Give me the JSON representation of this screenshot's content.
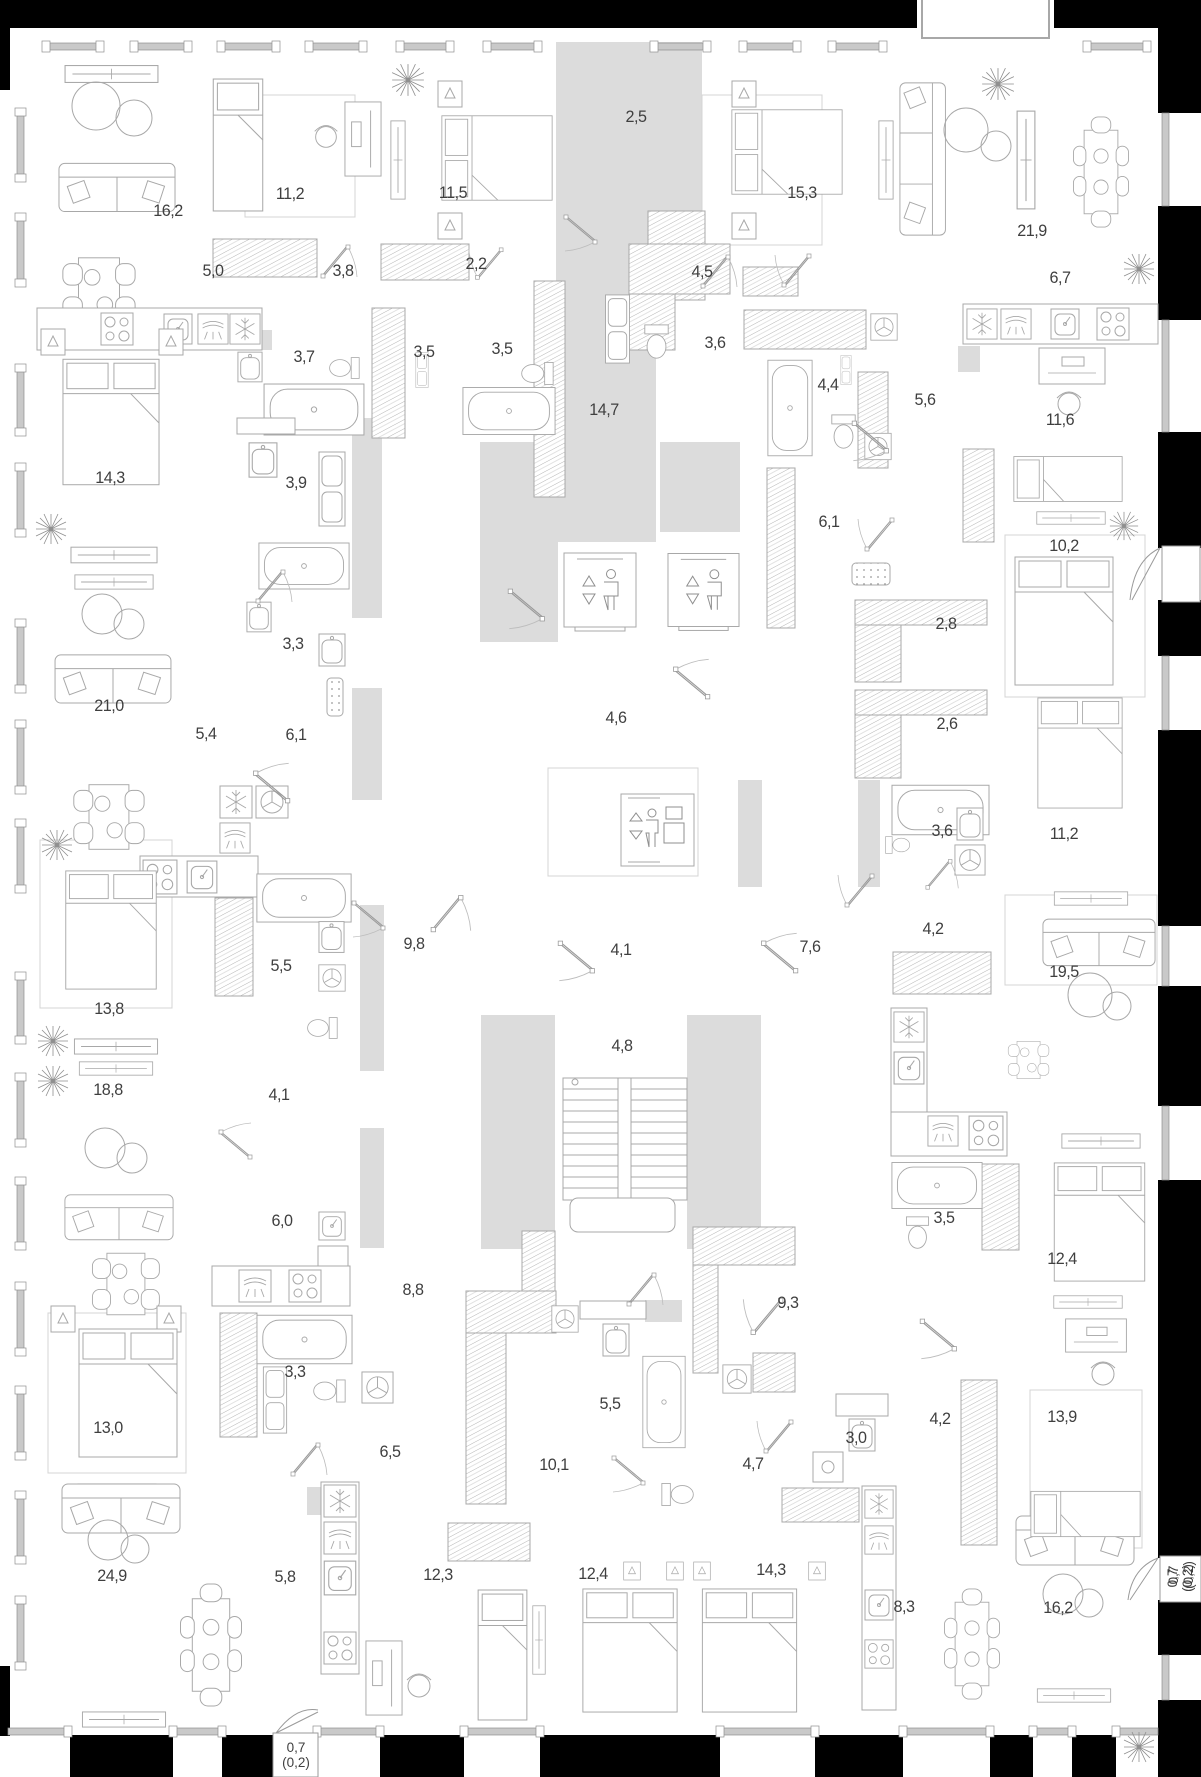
{
  "plan_title": "floor-plan",
  "colors": {
    "wall": "#000000",
    "corridor_fill": "#dcdcdc",
    "line": "#a8a8a8",
    "window_bar": "#c9c9c9",
    "label_color": "#3f3f3f"
  },
  "rooms": [
    {
      "label": "16,2",
      "x": 168,
      "y": 211
    },
    {
      "label": "11,2",
      "x": 290,
      "y": 194
    },
    {
      "label": "11,5",
      "x": 453,
      "y": 193
    },
    {
      "label": "2,5",
      "x": 636,
      "y": 117
    },
    {
      "label": "15,3",
      "x": 802,
      "y": 193
    },
    {
      "label": "21,9",
      "x": 1032,
      "y": 231
    },
    {
      "label": "5,0",
      "x": 213,
      "y": 271
    },
    {
      "label": "3,8",
      "x": 343,
      "y": 271
    },
    {
      "label": "2,2",
      "x": 476,
      "y": 264
    },
    {
      "label": "4,5",
      "x": 702,
      "y": 272
    },
    {
      "label": "6,7",
      "x": 1060,
      "y": 278
    },
    {
      "label": "3,7",
      "x": 304,
      "y": 357
    },
    {
      "label": "3,5",
      "x": 424,
      "y": 352
    },
    {
      "label": "3,5",
      "x": 502,
      "y": 349
    },
    {
      "label": "3,6",
      "x": 715,
      "y": 343
    },
    {
      "label": "4,4",
      "x": 828,
      "y": 385
    },
    {
      "label": "5,6",
      "x": 925,
      "y": 400
    },
    {
      "label": "11,6",
      "x": 1060,
      "y": 420
    },
    {
      "label": "14,7",
      "x": 604,
      "y": 410
    },
    {
      "label": "14,3",
      "x": 110,
      "y": 478
    },
    {
      "label": "3,9",
      "x": 296,
      "y": 483
    },
    {
      "label": "6,1",
      "x": 829,
      "y": 522
    },
    {
      "label": "10,2",
      "x": 1064,
      "y": 546
    },
    {
      "label": "2,8",
      "x": 946,
      "y": 624
    },
    {
      "label": "3,3",
      "x": 293,
      "y": 644
    },
    {
      "label": "21,0",
      "x": 109,
      "y": 706
    },
    {
      "label": "5,4",
      "x": 206,
      "y": 734
    },
    {
      "label": "6,1",
      "x": 296,
      "y": 735
    },
    {
      "label": "4,6",
      "x": 616,
      "y": 718
    },
    {
      "label": "2,6",
      "x": 947,
      "y": 724
    },
    {
      "label": "3,6",
      "x": 942,
      "y": 831
    },
    {
      "label": "11,2",
      "x": 1064,
      "y": 834
    },
    {
      "label": "19,5",
      "x": 1064,
      "y": 972
    },
    {
      "label": "5,5",
      "x": 281,
      "y": 966
    },
    {
      "label": "9,8",
      "x": 414,
      "y": 944
    },
    {
      "label": "4,1",
      "x": 621,
      "y": 950
    },
    {
      "label": "7,6",
      "x": 810,
      "y": 947
    },
    {
      "label": "4,2",
      "x": 933,
      "y": 929
    },
    {
      "label": "13,8",
      "x": 109,
      "y": 1009
    },
    {
      "label": "4,8",
      "x": 622,
      "y": 1046
    },
    {
      "label": "18,8",
      "x": 108,
      "y": 1090
    },
    {
      "label": "4,1",
      "x": 279,
      "y": 1095
    },
    {
      "label": "6,0",
      "x": 282,
      "y": 1221
    },
    {
      "label": "8,8",
      "x": 413,
      "y": 1290
    },
    {
      "label": "9,3",
      "x": 788,
      "y": 1303
    },
    {
      "label": "3,5",
      "x": 944,
      "y": 1218
    },
    {
      "label": "12,4",
      "x": 1062,
      "y": 1259
    },
    {
      "label": "3,3",
      "x": 295,
      "y": 1372
    },
    {
      "label": "13,0",
      "x": 108,
      "y": 1428
    },
    {
      "label": "5,5",
      "x": 610,
      "y": 1404
    },
    {
      "label": "3,0",
      "x": 856,
      "y": 1438
    },
    {
      "label": "4,2",
      "x": 940,
      "y": 1419
    },
    {
      "label": "13,9",
      "x": 1062,
      "y": 1417
    },
    {
      "label": "4,7",
      "x": 753,
      "y": 1464
    },
    {
      "label": "6,5",
      "x": 390,
      "y": 1452
    },
    {
      "label": "10,1",
      "x": 554,
      "y": 1465
    },
    {
      "label": "24,9",
      "x": 112,
      "y": 1576
    },
    {
      "label": "5,8",
      "x": 285,
      "y": 1577
    },
    {
      "label": "12,3",
      "x": 438,
      "y": 1575
    },
    {
      "label": "12,4",
      "x": 593,
      "y": 1574
    },
    {
      "label": "14,3",
      "x": 771,
      "y": 1570
    },
    {
      "label": "8,3",
      "x": 904,
      "y": 1607
    },
    {
      "label": "16,2",
      "x": 1058,
      "y": 1608
    }
  ],
  "balconies": [
    {
      "lines": [
        "0,7",
        "(0,2)"
      ],
      "x": 296,
      "y": 1755,
      "rotated": false
    },
    {
      "lines": [
        "0,7",
        "(0,2)"
      ],
      "x": 1181,
      "y": 1575,
      "rotated": true
    },
    {
      "lines": [
        "0,7",
        "(0,2)"
      ],
      "x": 1180,
      "y": 1578,
      "rotated": true
    }
  ],
  "icons": {
    "elevator_left": "elevator-icon",
    "elevator_right": "elevator-icon",
    "freight_elevator": "freight-elevator-icon",
    "staircase": "staircase"
  }
}
